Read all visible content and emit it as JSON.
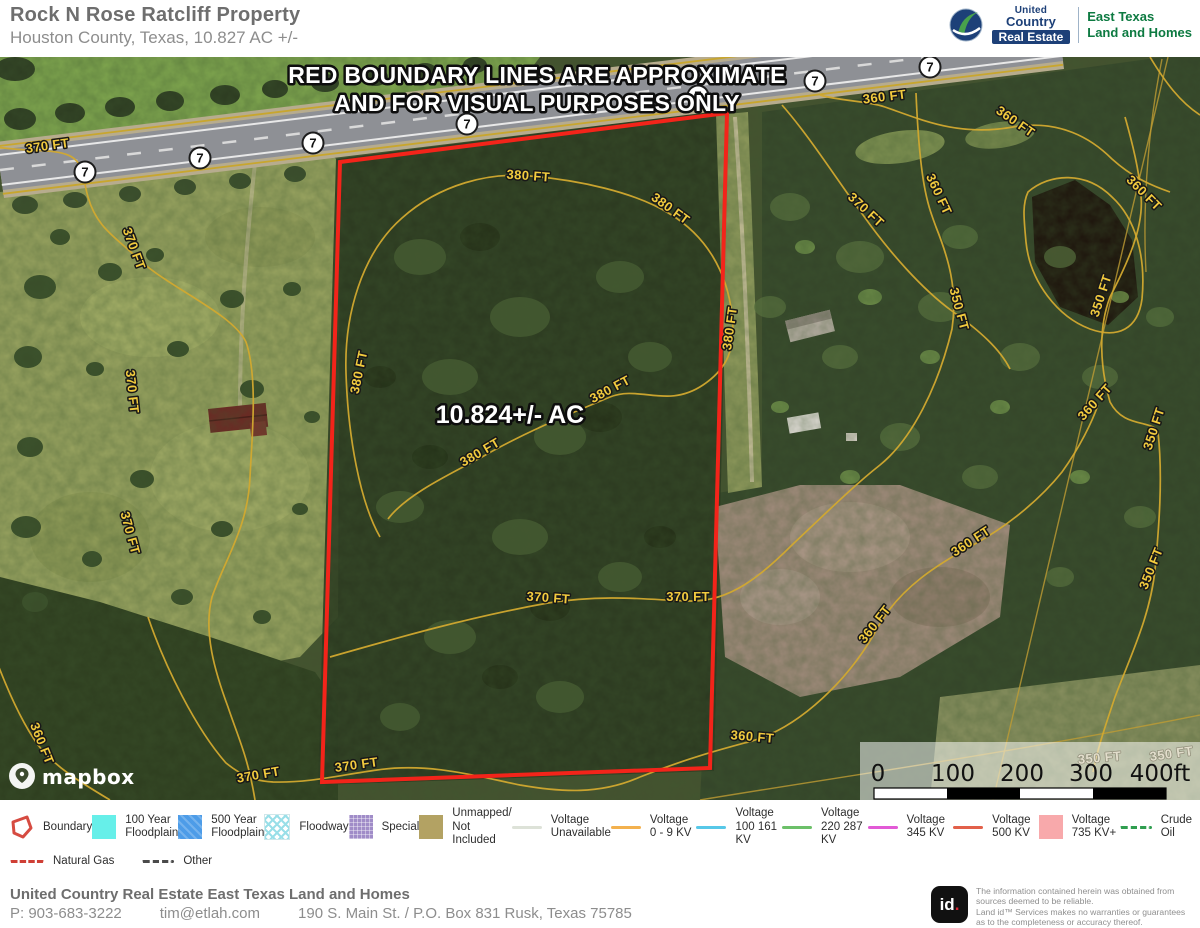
{
  "header": {
    "title": "Rock N Rose Ratcliff Property",
    "subtitle": "Houston County, Texas, 10.827 AC +/-",
    "logo": {
      "brand_line1": "United",
      "brand_line2": "Country",
      "brand_bar": "Real Estate",
      "division_line1": "East Texas",
      "division_line2": "Land and Homes"
    }
  },
  "map": {
    "warning_line1": "RED BOUNDARY LINES ARE APPROXIMATE",
    "warning_line2": "AND FOR VISUAL PURPOSES ONLY",
    "acreage_label": "10.824+/- AC",
    "attribution": "mapbox",
    "highway_shields": {
      "number": "7",
      "positions": [
        {
          "x": 85,
          "y": 115
        },
        {
          "x": 200,
          "y": 101
        },
        {
          "x": 313,
          "y": 86
        },
        {
          "x": 467,
          "y": 67
        },
        {
          "x": 698,
          "y": 39
        },
        {
          "x": 815,
          "y": 24
        },
        {
          "x": 930,
          "y": 10
        }
      ]
    },
    "contour_labels": [
      {
        "text": "370 FT",
        "x": 48,
        "y": 93,
        "r": -8
      },
      {
        "text": "380 FT",
        "x": 528,
        "y": 123,
        "r": 4
      },
      {
        "text": "380 FT",
        "x": 668,
        "y": 155,
        "r": 36
      },
      {
        "text": "380 FT",
        "x": 363,
        "y": 316,
        "r": -78
      },
      {
        "text": "380 FT",
        "x": 612,
        "y": 336,
        "r": -28
      },
      {
        "text": "380 FT",
        "x": 482,
        "y": 399,
        "r": -30
      },
      {
        "text": "380 FT",
        "x": 734,
        "y": 272,
        "r": -82
      },
      {
        "text": "370 FT",
        "x": 130,
        "y": 193,
        "r": 70
      },
      {
        "text": "370 FT",
        "x": 128,
        "y": 335,
        "r": 84
      },
      {
        "text": "370 FT",
        "x": 126,
        "y": 477,
        "r": 75
      },
      {
        "text": "360 FT",
        "x": 38,
        "y": 688,
        "r": 68
      },
      {
        "text": "370 FT",
        "x": 259,
        "y": 722,
        "r": -10
      },
      {
        "text": "370 FT",
        "x": 357,
        "y": 712,
        "r": -8
      },
      {
        "text": "370 FT",
        "x": 548,
        "y": 545,
        "r": 4
      },
      {
        "text": "370 FT",
        "x": 688,
        "y": 544,
        "r": 0
      },
      {
        "text": "360 FT",
        "x": 885,
        "y": 44,
        "r": -7
      },
      {
        "text": "360 FT",
        "x": 1013,
        "y": 68,
        "r": 35
      },
      {
        "text": "360 FT",
        "x": 935,
        "y": 139,
        "r": 65
      },
      {
        "text": "360 FT",
        "x": 1141,
        "y": 139,
        "r": 45
      },
      {
        "text": "370 FT",
        "x": 863,
        "y": 156,
        "r": 43
      },
      {
        "text": "350 FT",
        "x": 1105,
        "y": 240,
        "r": -72
      },
      {
        "text": "350 FT",
        "x": 955,
        "y": 253,
        "r": 75
      },
      {
        "text": "360 FT",
        "x": 1098,
        "y": 348,
        "r": -48
      },
      {
        "text": "350 FT",
        "x": 1158,
        "y": 373,
        "r": -72
      },
      {
        "text": "350 FT",
        "x": 1155,
        "y": 513,
        "r": -68
      },
      {
        "text": "360 FT",
        "x": 973,
        "y": 488,
        "r": -33
      },
      {
        "text": "360 FT",
        "x": 878,
        "y": 570,
        "r": -52
      },
      {
        "text": "360 FT",
        "x": 752,
        "y": 684,
        "r": 5
      },
      {
        "text": "350 FT",
        "x": 1100,
        "y": 705,
        "r": -5,
        "light": true
      },
      {
        "text": "350 FT",
        "x": 1172,
        "y": 701,
        "r": -8,
        "light": true
      }
    ],
    "scale_bar": {
      "ticks": [
        "0",
        "100",
        "200",
        "300",
        "400ft"
      ]
    }
  },
  "legend": {
    "items": [
      {
        "label": "Boundary"
      },
      {
        "label": "100 Year Floodplain"
      },
      {
        "label": "500 Year Floodplain"
      },
      {
        "label": "Floodway"
      },
      {
        "label": "Special"
      },
      {
        "label": "Unmapped/ Not Included"
      },
      {
        "label": "Voltage Unavailable"
      },
      {
        "label": "Voltage 0 - 9 KV"
      },
      {
        "label": "Voltage 100 161 KV"
      },
      {
        "label": "Voltage 220 287 KV"
      },
      {
        "label": "Voltage 345 KV"
      },
      {
        "label": "Voltage 500 KV"
      },
      {
        "label": "Voltage 735 KV+"
      },
      {
        "label": "Crude Oil"
      },
      {
        "label": "Natural Gas"
      },
      {
        "label": "Other"
      }
    ]
  },
  "footer": {
    "company": "United Country Real Estate East Texas Land and Homes",
    "phone": "P: 903-683-3222",
    "email": "tim@etlah.com",
    "address": "190 S. Main St. / P.O. Box 831 Rusk, Texas 75785",
    "id_mark_text": "id",
    "id_mark_dot": ".",
    "disclaimer": [
      "The information contained herein was obtained from",
      "sources deemed to be reliable.",
      "Land id™ Services makes no warranties or guarantees",
      "as to the completeness or accuracy thereof."
    ]
  },
  "colors": {
    "boundary_red": "#f3241a",
    "contour_yellow": "#d2a92f",
    "brand_blue": "#1d4078",
    "brand_green": "#0d7a41",
    "id_dot_red": "#d92332"
  }
}
